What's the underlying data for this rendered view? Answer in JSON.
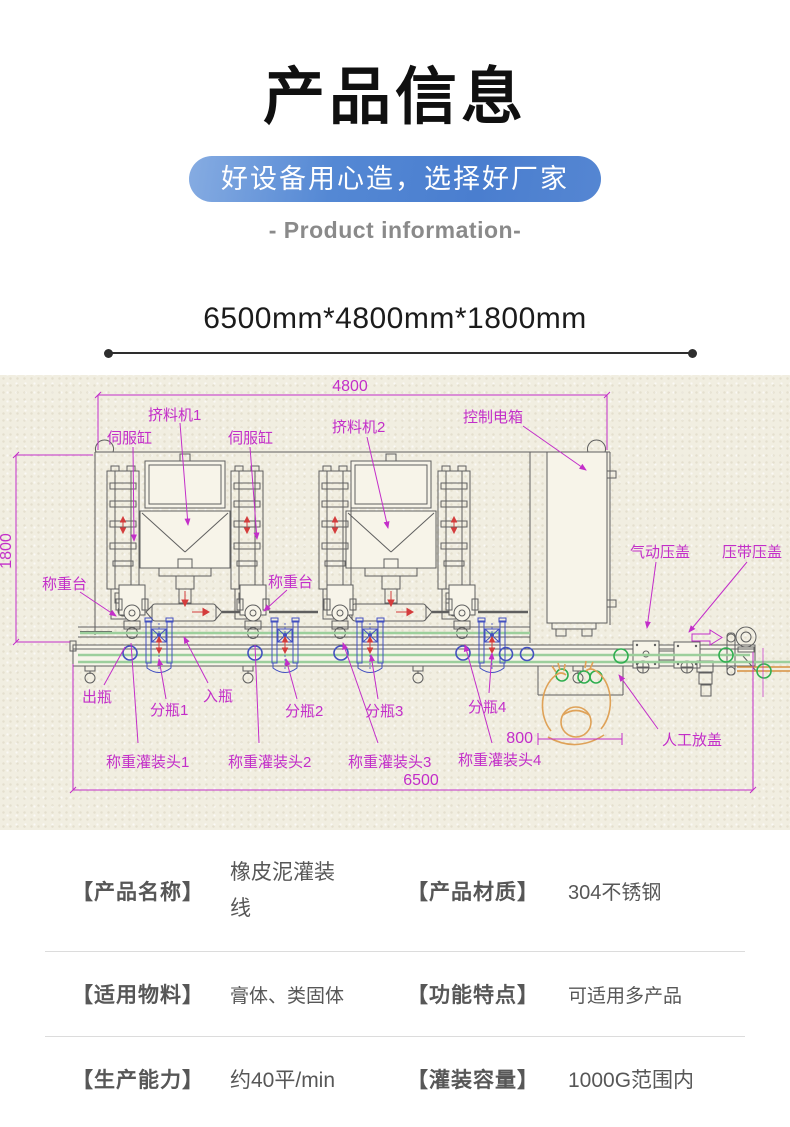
{
  "header": {
    "title": "产品信息",
    "banner": "好设备用心造，选择好厂家",
    "subtitle": "- Product information-",
    "size_text": "6500mm*4800mm*1800mm"
  },
  "diagram": {
    "labels": {
      "dim_width": "4800",
      "dim_height": "1800",
      "dim_total": "6500",
      "dim_workspace": "800",
      "extruder1": "挤料机1",
      "servo_cyl_1": "伺服缸",
      "servo_cyl_2": "伺服缸",
      "extruder2": "挤料机2",
      "control_box": "控制电箱",
      "pneumatic_capping": "气动压盖",
      "belt_capping": "压带压盖",
      "weigh_platform_1": "称重台",
      "weigh_platform_2": "称重台",
      "bottle_out": "出瓶",
      "divider1": "分瓶1",
      "bottle_in": "入瓶",
      "divider2": "分瓶2",
      "divider3": "分瓶3",
      "divider4": "分瓶4",
      "fill_head1": "称重灌装头1",
      "fill_head2": "称重灌装头2",
      "fill_head3": "称重灌装头3",
      "fill_head4": "称重灌装头4",
      "manual_capping": "人工放盖"
    }
  },
  "colors": {
    "banner_blue": "#4a7ecf",
    "annotation_magenta": "#c32ec9",
    "machine_line_gray": "#5f5f5f",
    "belt_green": "#9ccf9c",
    "bottle_green": "#2fae4f",
    "mechanism_blue": "#4350c0",
    "person_orange": "#dfa258",
    "arrow_red": "#d43c3c",
    "paper_beige": "#f1eee1"
  },
  "specs": {
    "rows": [
      {
        "label1": "【产品名称】",
        "value1": "橡皮泥灌装线",
        "label2": "【产品材质】",
        "value2": "304不锈钢"
      },
      {
        "label1": "【适用物料】",
        "value1": "膏体、类固体",
        "label2": "【功能特点】",
        "value2": "可适用多产品"
      },
      {
        "label1": "【生产能力】",
        "value1": "约40平/min",
        "label2": "【灌装容量】",
        "value2": "1000G范围内"
      }
    ]
  }
}
